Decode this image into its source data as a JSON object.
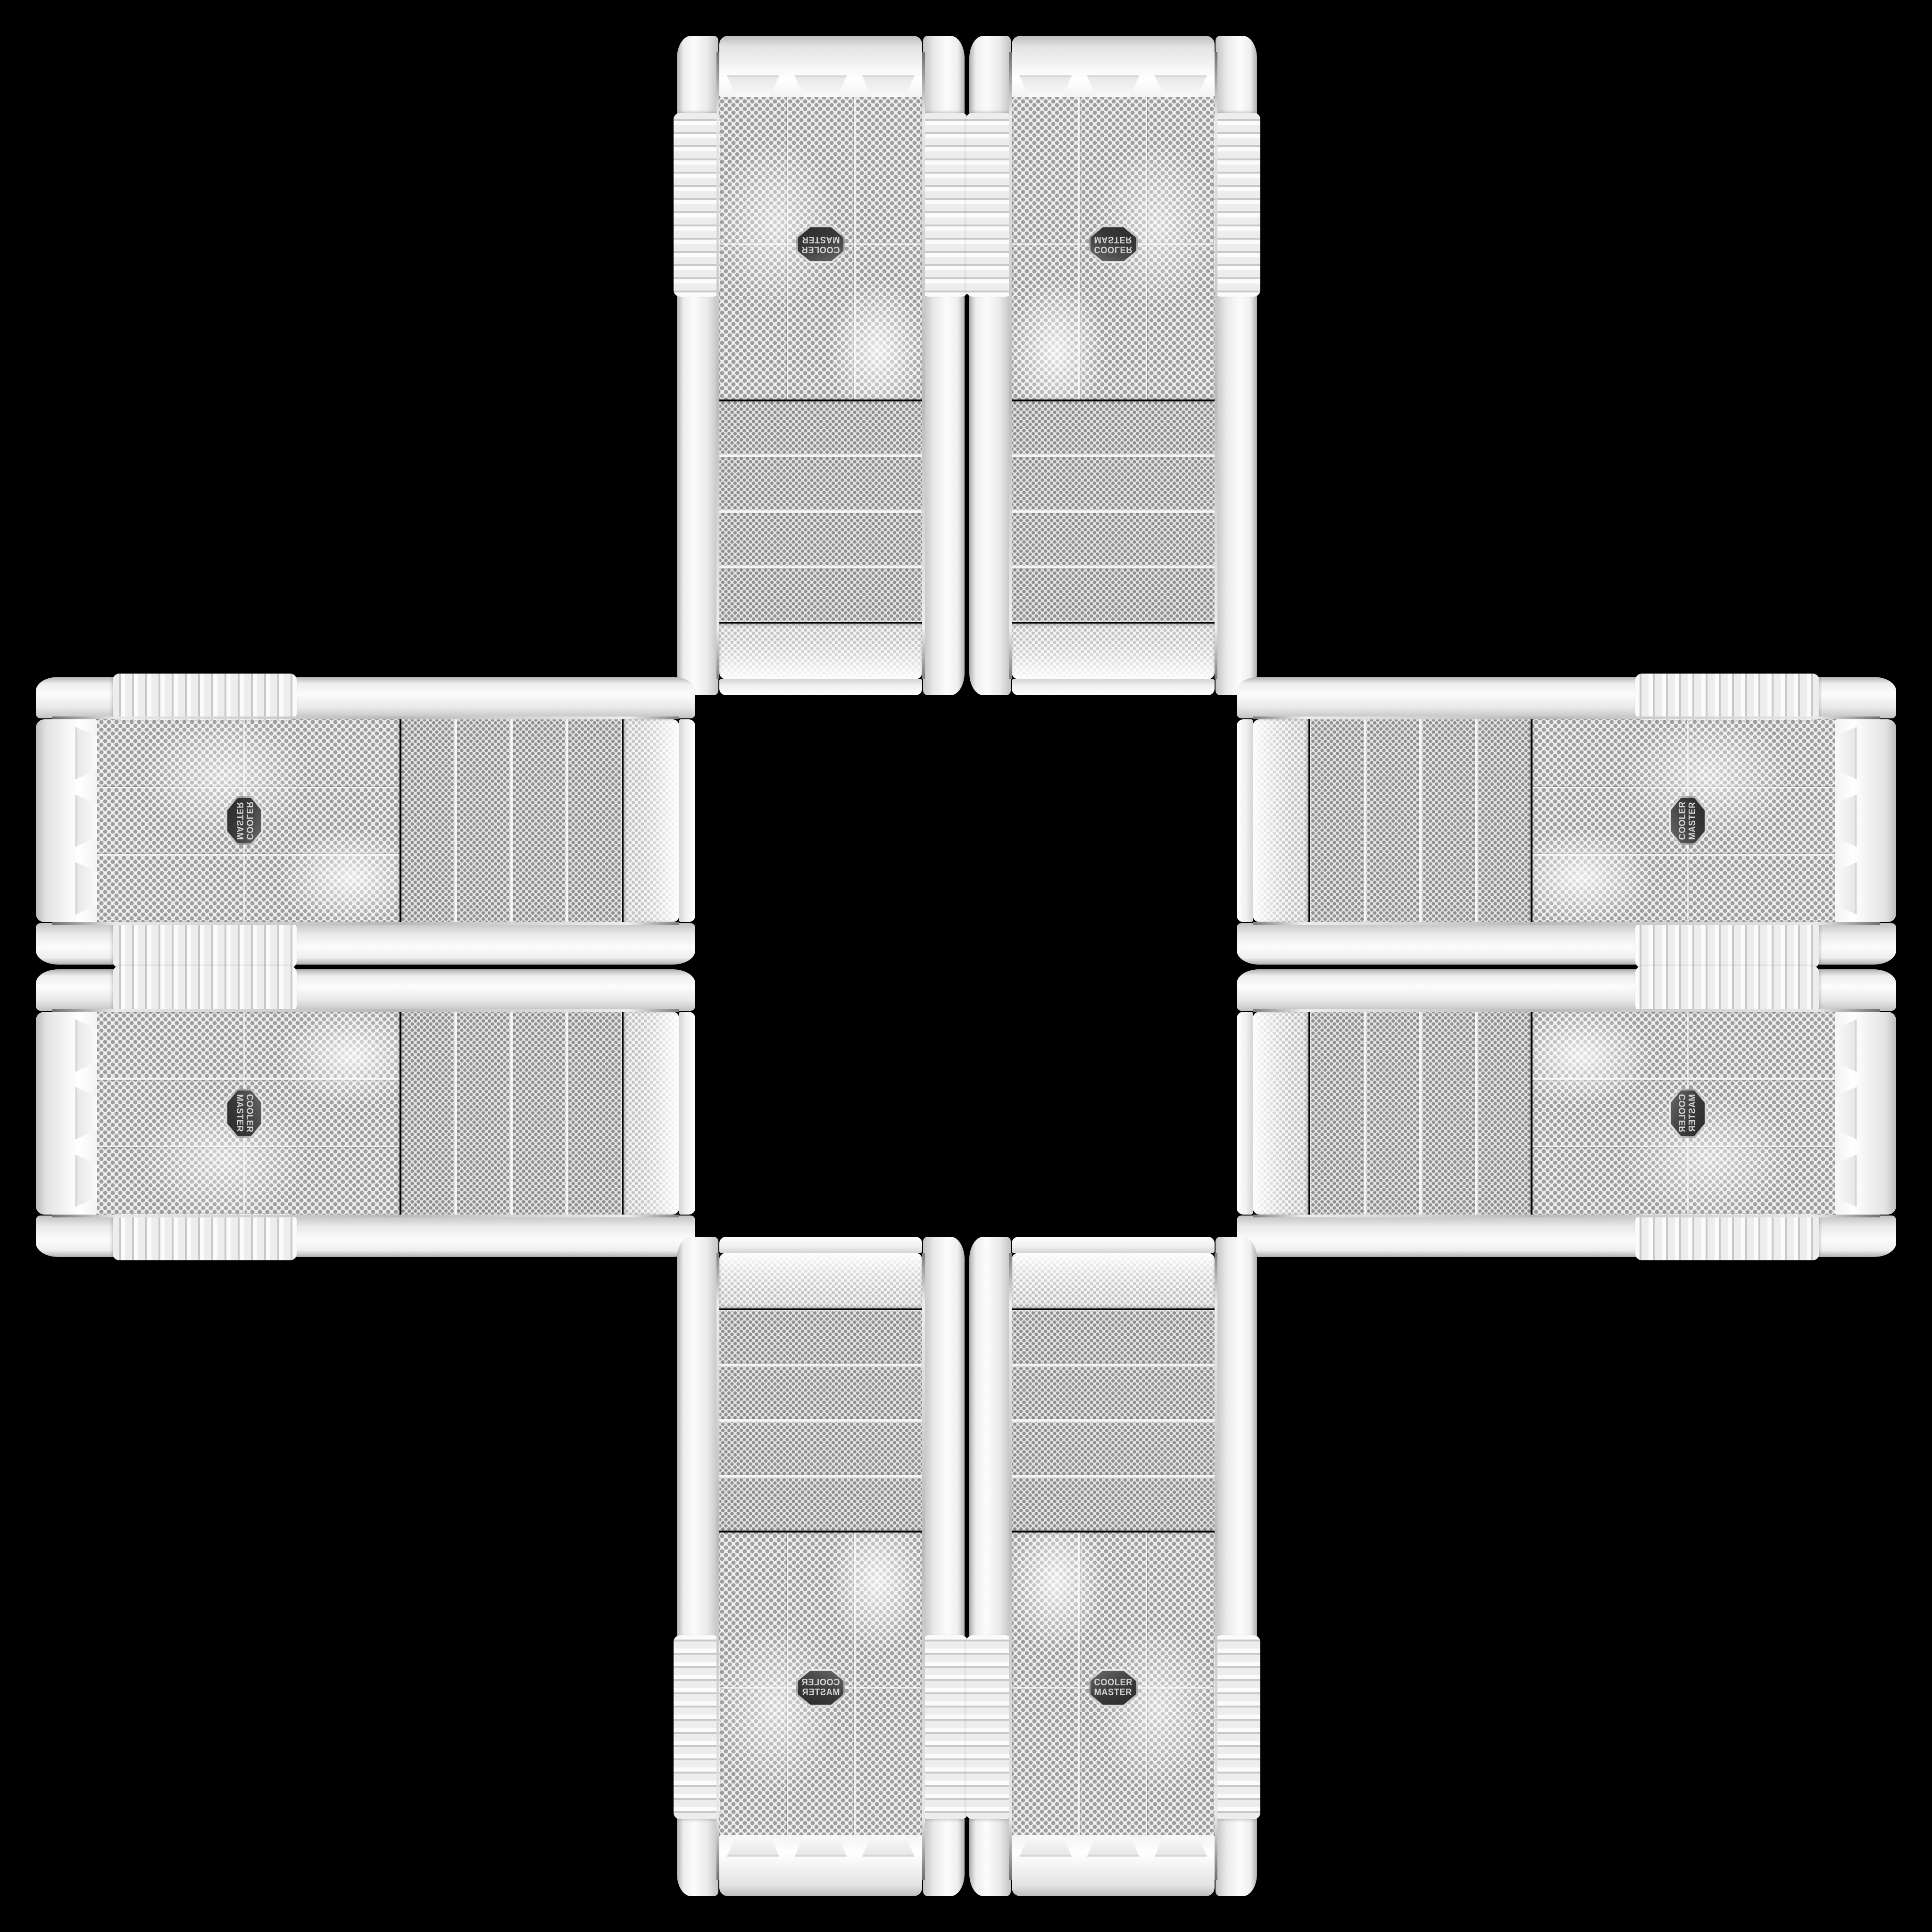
{
  "badge": {
    "line1": "COOLER",
    "line2": "MASTER",
    "background": "#3a3a3a",
    "text_color": "#d4d4d4"
  },
  "palette": {
    "background": "#000000",
    "case_body": "#f2f2f2",
    "mesh_base": "#ededed",
    "mesh_hole_gray": "#9e9e9e",
    "chrome_trim": "#b9b9b9"
  },
  "cases": [
    {
      "id": "top-left",
      "orientation": "rotated-180"
    },
    {
      "id": "top-right",
      "orientation": "flipped-vertical"
    },
    {
      "id": "left-top",
      "orientation": "rotated-90-cw-mirrored"
    },
    {
      "id": "left-bottom",
      "orientation": "rotated-90-cw"
    },
    {
      "id": "right-top",
      "orientation": "rotated-90-ccw"
    },
    {
      "id": "right-bottom",
      "orientation": "rotated-90-ccw-mirrored"
    },
    {
      "id": "bottom-left",
      "orientation": "mirrored-horizontal"
    },
    {
      "id": "bottom-right",
      "orientation": "upright"
    }
  ]
}
